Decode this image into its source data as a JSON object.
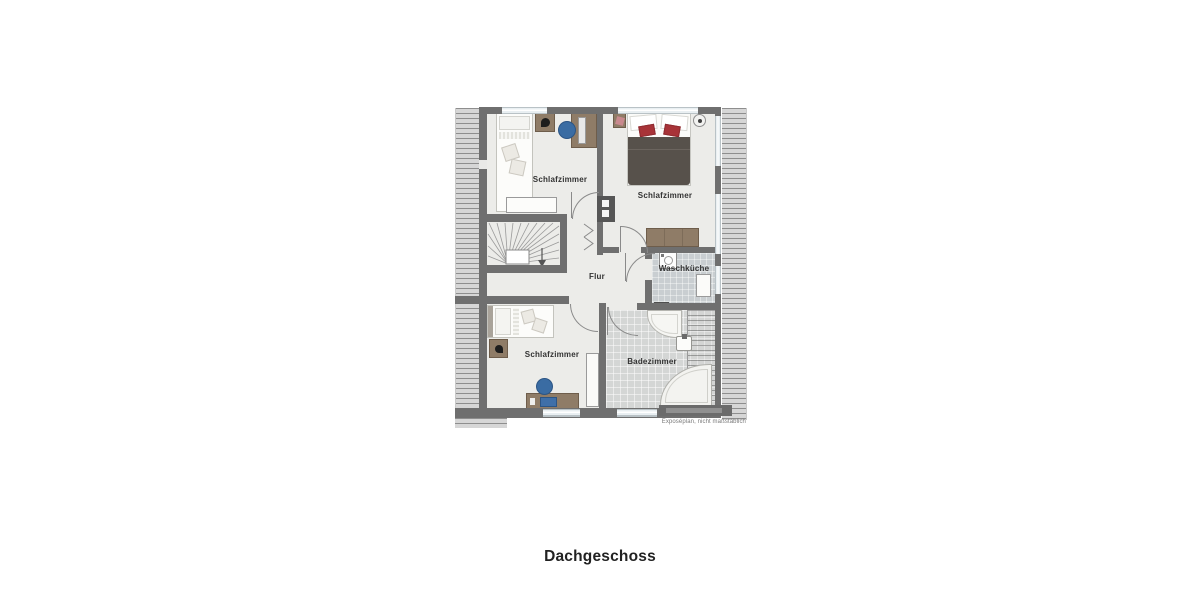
{
  "title": "Dachgeschoss",
  "caption": "Exposéplan, nicht maßstäblich",
  "rooms": [
    {
      "id": "schlafzimmer-top-left",
      "label": "Schlafzimmer"
    },
    {
      "id": "schlafzimmer-top-right",
      "label": "Schlafzimmer"
    },
    {
      "id": "flur",
      "label": "Flur"
    },
    {
      "id": "waschkueche",
      "label": "Waschküche"
    },
    {
      "id": "schlafzimmer-bottom-left",
      "label": "Schlafzimmer"
    },
    {
      "id": "badezimmer",
      "label": "Badezimmer"
    }
  ],
  "furniture": {
    "schlafzimmer_top_left": [
      "single-bed",
      "nightstand",
      "table-lamp",
      "desk",
      "monitor",
      "office-chair",
      "sideboard"
    ],
    "schlafzimmer_top_right": [
      "double-bed",
      "nightstand",
      "wall-lamp",
      "dresser"
    ],
    "schlafzimmer_bottom_left": [
      "single-bed",
      "nightstand",
      "table-lamp",
      "desk",
      "laptop",
      "office-chair",
      "wardrobe"
    ],
    "badezimmer": [
      "corner-shower",
      "washbasin",
      "corner-bathtub"
    ],
    "waschkueche": [
      "washing-machine",
      "appliance"
    ],
    "flur": [
      "winder-staircase",
      "folding-door"
    ]
  },
  "colors": {
    "wall": "#6f6f6f",
    "floor": "#ecece9",
    "tile_floor": "#d4d6d5",
    "utility_floor": "#c9ced1",
    "rib": "#8e8e8e",
    "rib_bg": "#d6d6d6",
    "window": "#e9eff2",
    "wood": "#8f7c67",
    "wood_dark": "#6e5d4b",
    "duvet": "#57514b",
    "pillow_red": "#a83338",
    "chair_blue": "#3a6ca3",
    "text": "#333333",
    "title_text": "#222222",
    "caption_text": "#7a7a7a"
  }
}
